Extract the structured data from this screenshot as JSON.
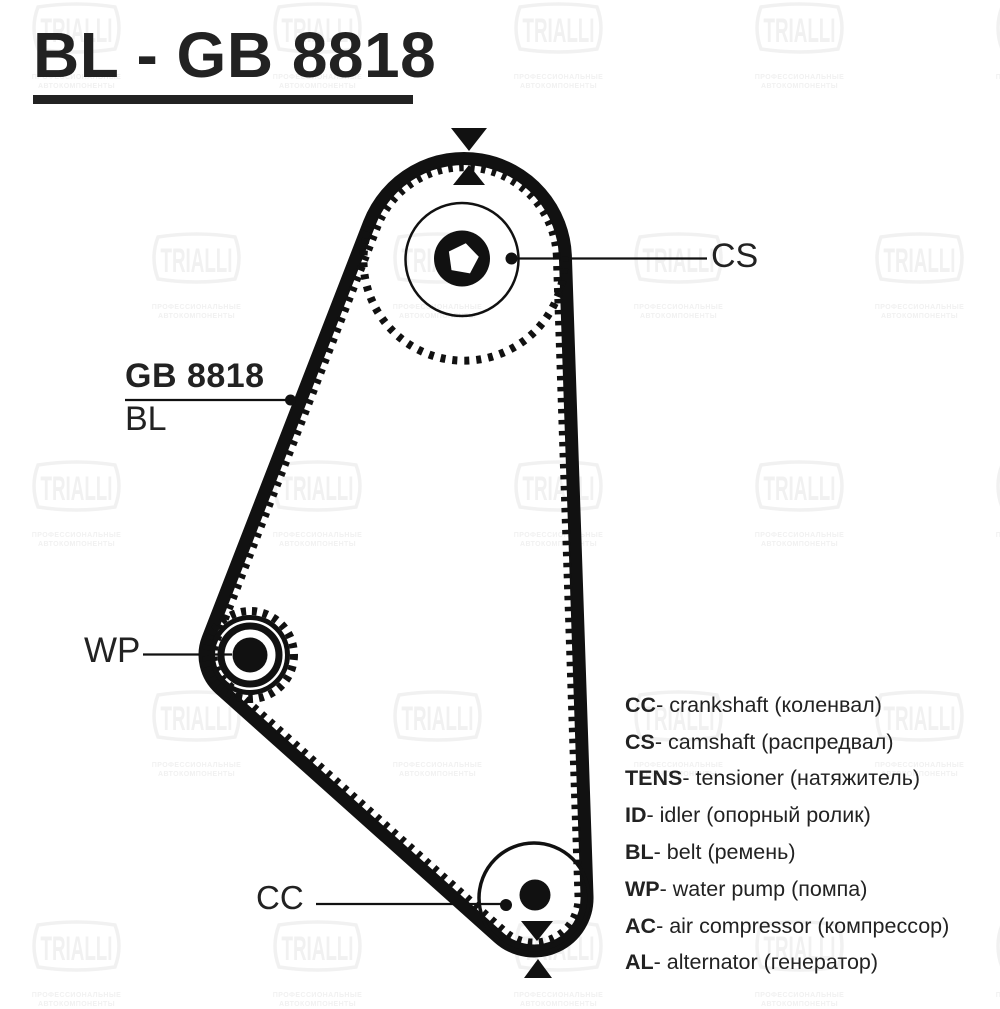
{
  "page": {
    "title": "BL - GB 8818",
    "bg": "#ffffff",
    "ink_text": "#222222",
    "ink_diagram": "#111111"
  },
  "diagram": {
    "belt_label": {
      "line1": "GB 8818",
      "line2": "BL"
    },
    "labels": {
      "camshaft": "CS",
      "water_pump": "WP",
      "crankshaft": "CC"
    }
  },
  "legend": {
    "separator": " - ",
    "items": [
      {
        "abbr": "CC",
        "name": "crankshaft (коленвал)"
      },
      {
        "abbr": "CS",
        "name": "camshaft (распредвал)"
      },
      {
        "abbr": "TENS",
        "name": "tensioner (натяжитель)"
      },
      {
        "abbr": "ID",
        "name": "idler (опорный ролик)"
      },
      {
        "abbr": "BL",
        "name": "belt (ремень)"
      },
      {
        "abbr": "WP",
        "name": "water pump (помпа)"
      },
      {
        "abbr": "AC",
        "name": "air compressor (компрессор)"
      },
      {
        "abbr": "AL",
        "name": "alternator (генератор)"
      }
    ]
  },
  "watermark": {
    "brand": "TRIALLI",
    "subtext1": "ПРОФЕССИОНАЛЬНЫЕ",
    "subtext2": "АВТОКОМПОНЕНТЫ",
    "color": "#f1f1f1",
    "grid": [
      {
        "y": 2,
        "xs": [
          28,
          269,
          510,
          751,
          992
        ]
      },
      {
        "y": 232,
        "xs": [
          148,
          389,
          630,
          871
        ]
      },
      {
        "y": 460,
        "xs": [
          28,
          269,
          510,
          751,
          992
        ]
      },
      {
        "y": 690,
        "xs": [
          148,
          389,
          630,
          871
        ]
      },
      {
        "y": 920,
        "xs": [
          28,
          269,
          510,
          751,
          992
        ]
      }
    ]
  }
}
